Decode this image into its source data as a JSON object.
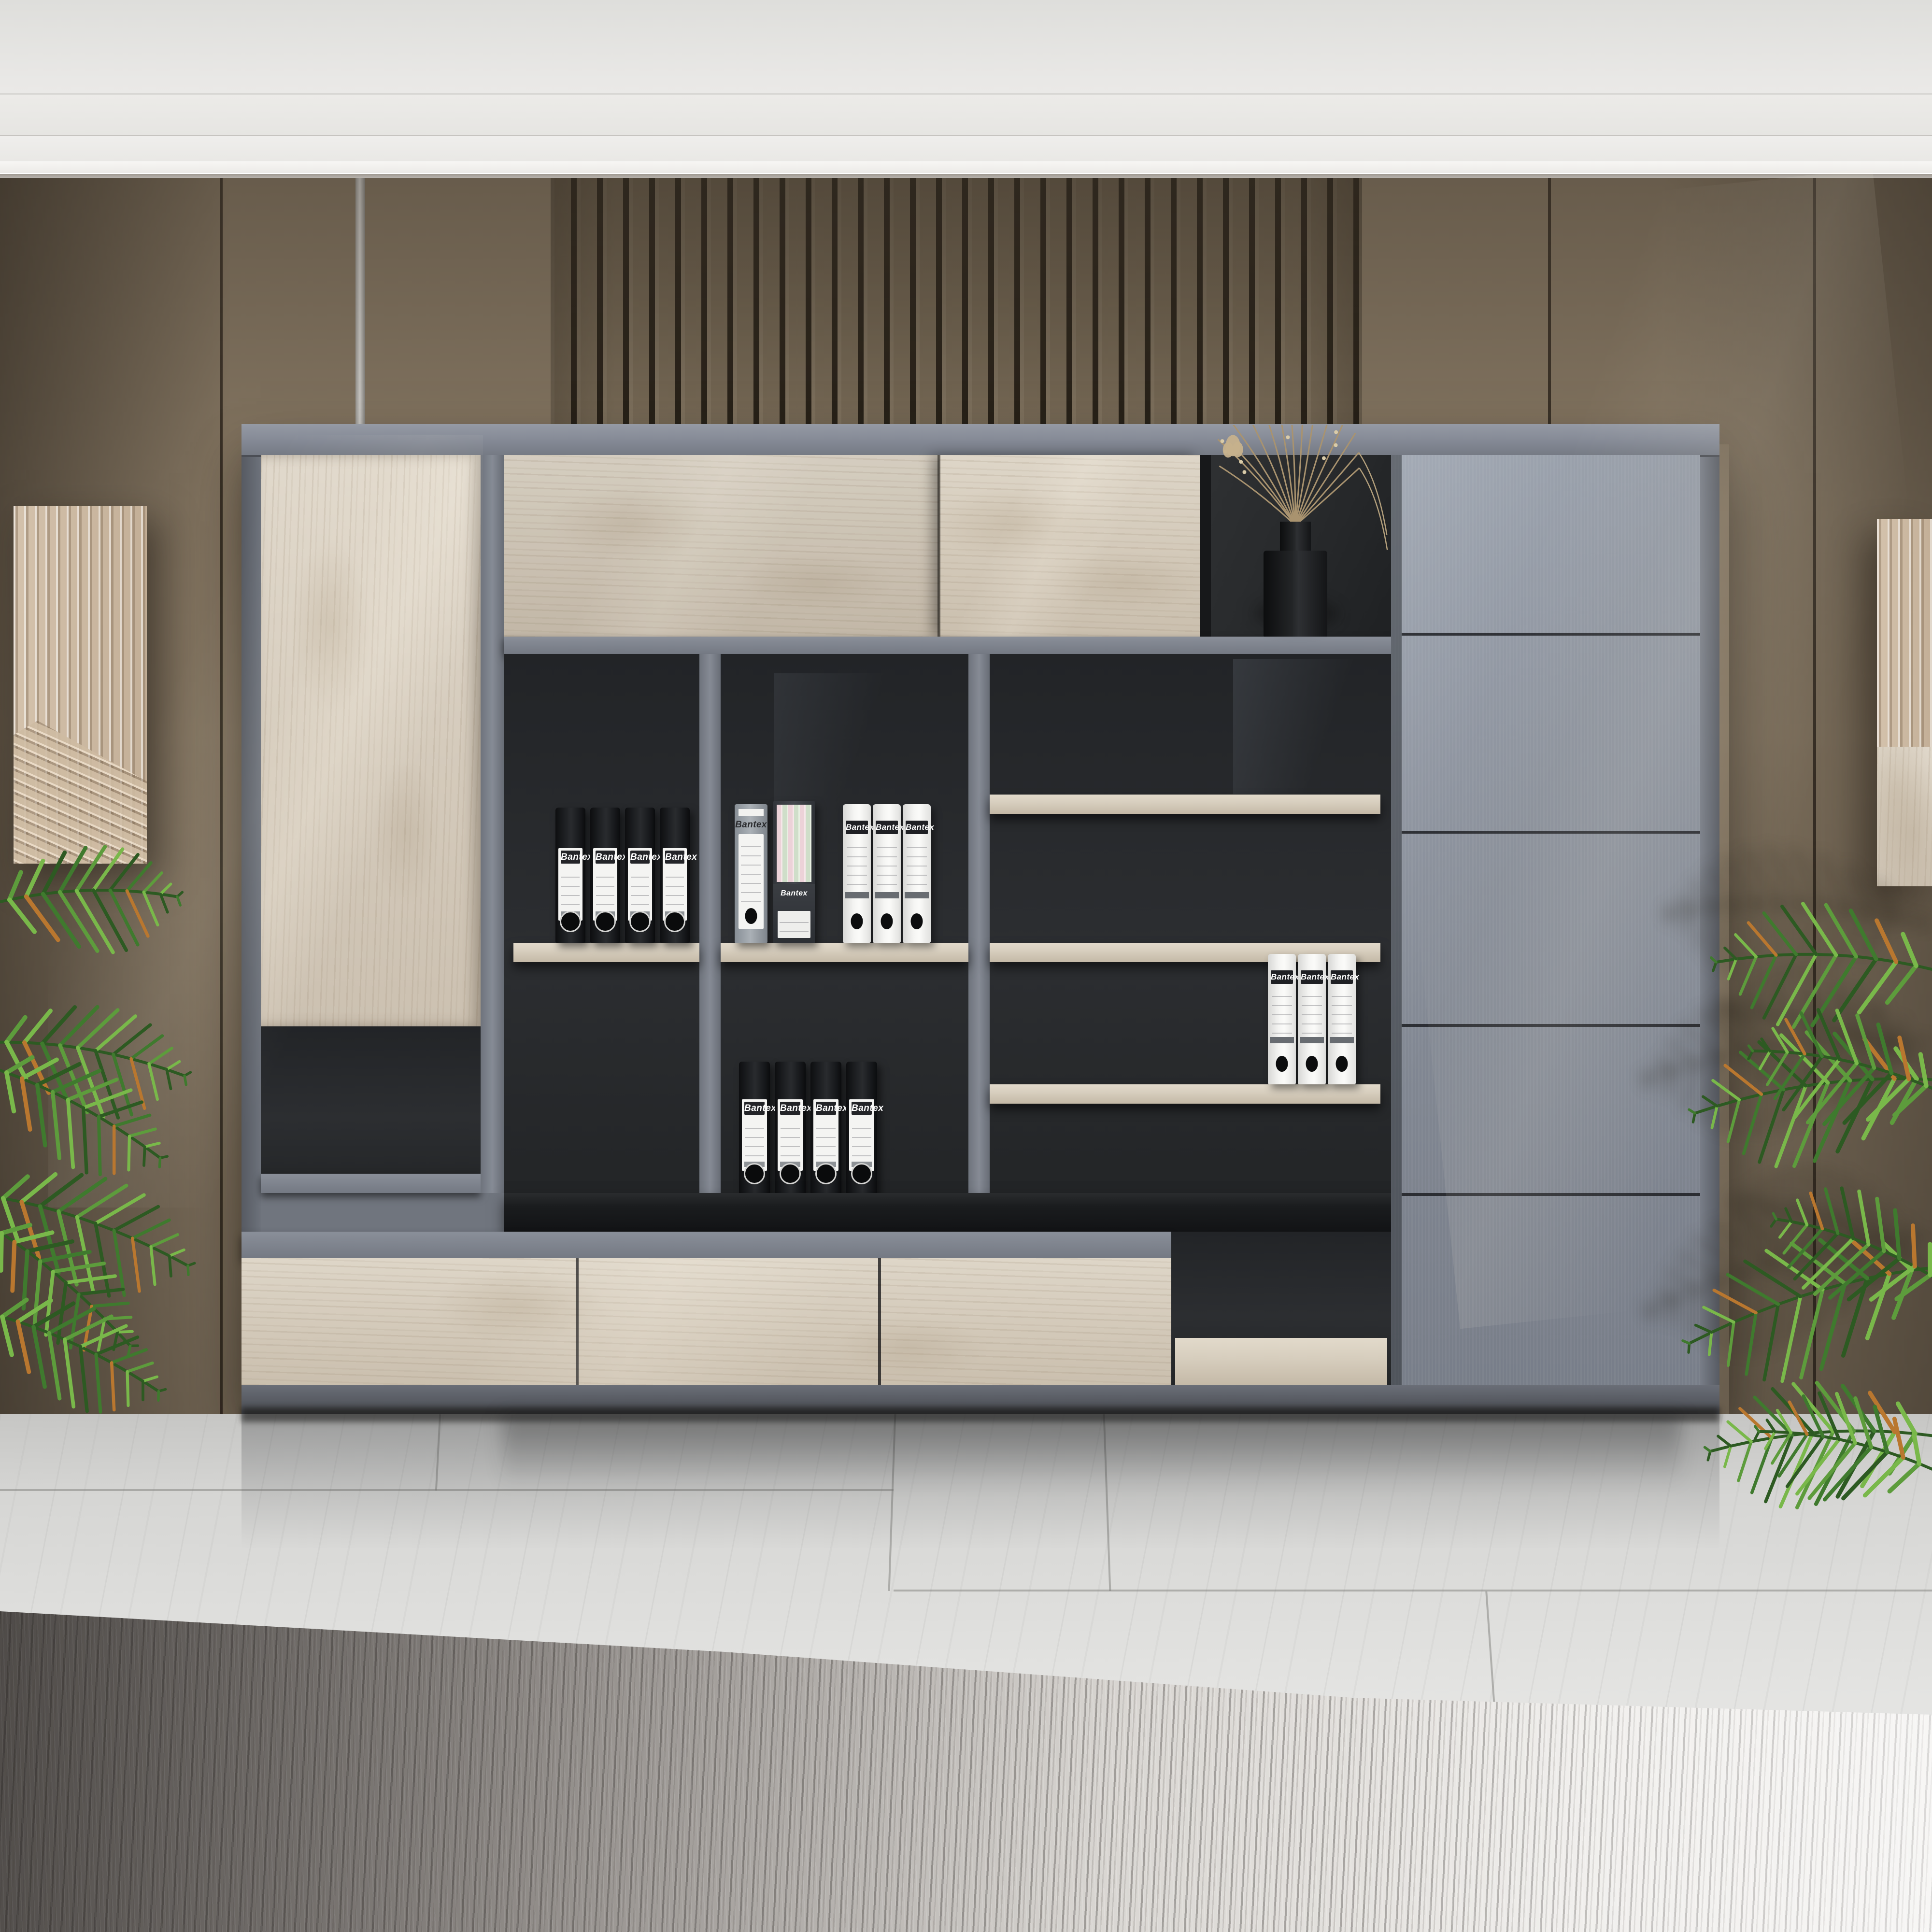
{
  "scene": {
    "kind": "interior product render",
    "subject": "modern gray and whitewashed-oak office wall shelving cabinet",
    "setting": "office lounge with taupe panelled wall, white crown molding, marble floor and distressed gray rug",
    "decor": [
      "black vase with dried tan flowers",
      "palm plant left",
      "palm plant right",
      "ribbed beige wall art panel left",
      "ribbed beige wall art panel right"
    ]
  },
  "items": {
    "binders_black_upper": {
      "brand": "Bantex",
      "count": 4,
      "color": "#17181a",
      "location": "left open bay, middle shelf"
    },
    "binders_black_lower": {
      "brand": "Bantex",
      "count": 4,
      "color": "#17181a",
      "location": "center bay, on black counter"
    },
    "binders_white_bay_b": {
      "brand": "Bantex",
      "count": 3,
      "color": "#f2f2f0",
      "location": "center bay, middle shelf"
    },
    "binders_white_bay_c": {
      "brand": "Bantex",
      "count": 3,
      "color": "#f2f2f0",
      "location": "right open bay, lower shelf"
    },
    "file_box": {
      "brand": "Bantex",
      "count": 1,
      "color": "#9aa0a6",
      "location": "center bay, middle shelf"
    },
    "magazine_file": {
      "brand": "Bantex",
      "count": 1,
      "color": "#3a3d41",
      "contents": "pink and green folders",
      "location": "center bay, middle shelf"
    }
  },
  "palette": {
    "wall": "#8c7d68",
    "wall_dark": "#6e6353",
    "molding": "#f2f1ef",
    "cabinet_frame": "#767b85",
    "wood_light": "#ddd5c8",
    "interior_dark": "#2a2c2f",
    "counter_black": "#1b1d1f",
    "column_gray": "#8a909b",
    "marble": "#dcdcda",
    "rug_dark": "#7d7874",
    "rug_light": "#eceae7",
    "plant_greens": [
      "#2d5a22",
      "#3f7a2e",
      "#5d9c3c",
      "#79b84a"
    ],
    "plant_accent": "#b9772f",
    "plant_shadow": "rgba(35,30,23,0.45)",
    "flower_tan": "#c6b18c",
    "flower_stem": "#a9936f",
    "vase_black": "#141517"
  }
}
